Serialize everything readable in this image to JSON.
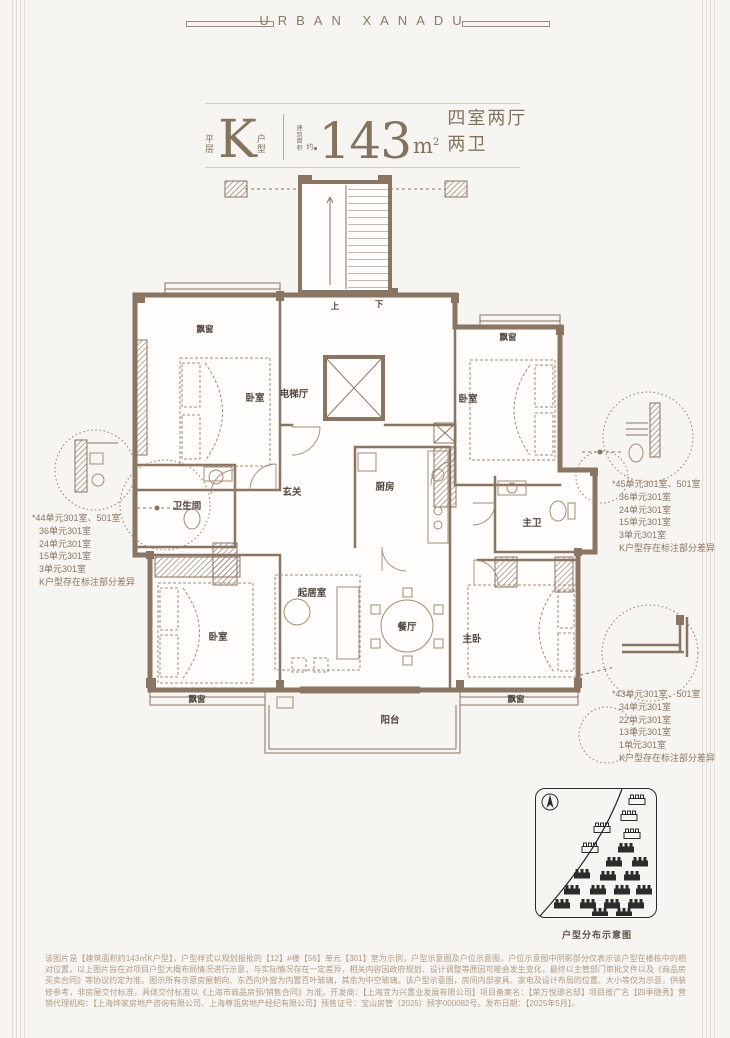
{
  "brand": {
    "name": "URBAN XANADU"
  },
  "title": {
    "prefix_top": "平",
    "prefix_bottom": "层",
    "type_letter": "K",
    "suffix_top": "户",
    "suffix_bottom": "型",
    "area_label_line1": "建筑",
    "area_label_line2": "面积",
    "area_label_tail": "约",
    "area_value": "143",
    "area_unit_letter": "m",
    "area_unit_sup": "2",
    "spec": "四室两厅两卫"
  },
  "plan": {
    "rooms": {
      "bay_top_left": "飘窗",
      "bed_top_left": "卧室",
      "elevator_hall": "电梯厅",
      "bath": "卫生间",
      "foyer": "玄关",
      "kitchen": "厨房",
      "bed_top_right": "卧室",
      "bay_top_right": "飘窗",
      "master_bath": "主卫",
      "living": "起居室",
      "bed_bottom_left": "卧室",
      "dining": "餐厅",
      "master_bed": "主卧",
      "bay_bottom_left": "飘窗",
      "bay_bottom_right": "飘窗",
      "balcony": "阳台",
      "stair_up": "上",
      "stair_down": "下"
    }
  },
  "callouts": {
    "left": [
      "*44单元301室、501室",
      "36单元301室",
      "24单元301室",
      "15单元301室",
      "3单元301室",
      "K户型存在标注部分差异"
    ],
    "right_top": [
      "*45单元301室、501室",
      "36单元301室",
      "24单元301室",
      "15单元301室",
      "3单元301室",
      "K户型存在标注部分差异"
    ],
    "right_bottom": [
      "*43单元301室、501室",
      "34单元301室",
      "22单元301室",
      "13单元301室",
      "1单元301室",
      "K户型存在标注部分差异"
    ]
  },
  "site_map": {
    "caption": "户型分布示意图"
  },
  "disclaimer": "该图片是【建筑面积约143㎡K户型】，户型样式以规划报批的【12】#楼【56】单元【301】室为示例，户型示意图及户位示意图，户位示意图中阴影部分仅表示该户型在楼栋中的相对位置，以上图片旨在对项目户型大概布局情况进行示意，与实际情况存在一定差异，相关内容因政府规划、设计调整等原因可能会发生变化，最终以主管部门审批文件以及《商品房买卖合同》等协议约定为准。图示所有示意房屋朝向、东西向外窗为内置百叶玻璃，其余为中空玻璃。该户型示意图，房间内部家具、家电及设计布局的位置、大小等仅为示意，供装修参考，非房屋交付标准，具体交付标准以《上海市商品房预/销售合同》为准。开发商：【上海宜为兴置业发展有限公司】项目备案名：【荣万悦璟名邸】项目推广名【四季隐秀】营销代理机构：【上海烨家房地产咨询有限公司、上海尊瓴房地产经纪有限公司】预售证号：宝山房管（2025）预字000082号。发布日期：【2025年5月】。",
  "colors": {
    "accent_brown": "#8a7462",
    "title_brown": "#84735f",
    "note_brown": "#8a7461",
    "disclaimer_brown": "#b19b85",
    "map_dark": "#2b2b2b",
    "background": "#f7f5f2"
  }
}
